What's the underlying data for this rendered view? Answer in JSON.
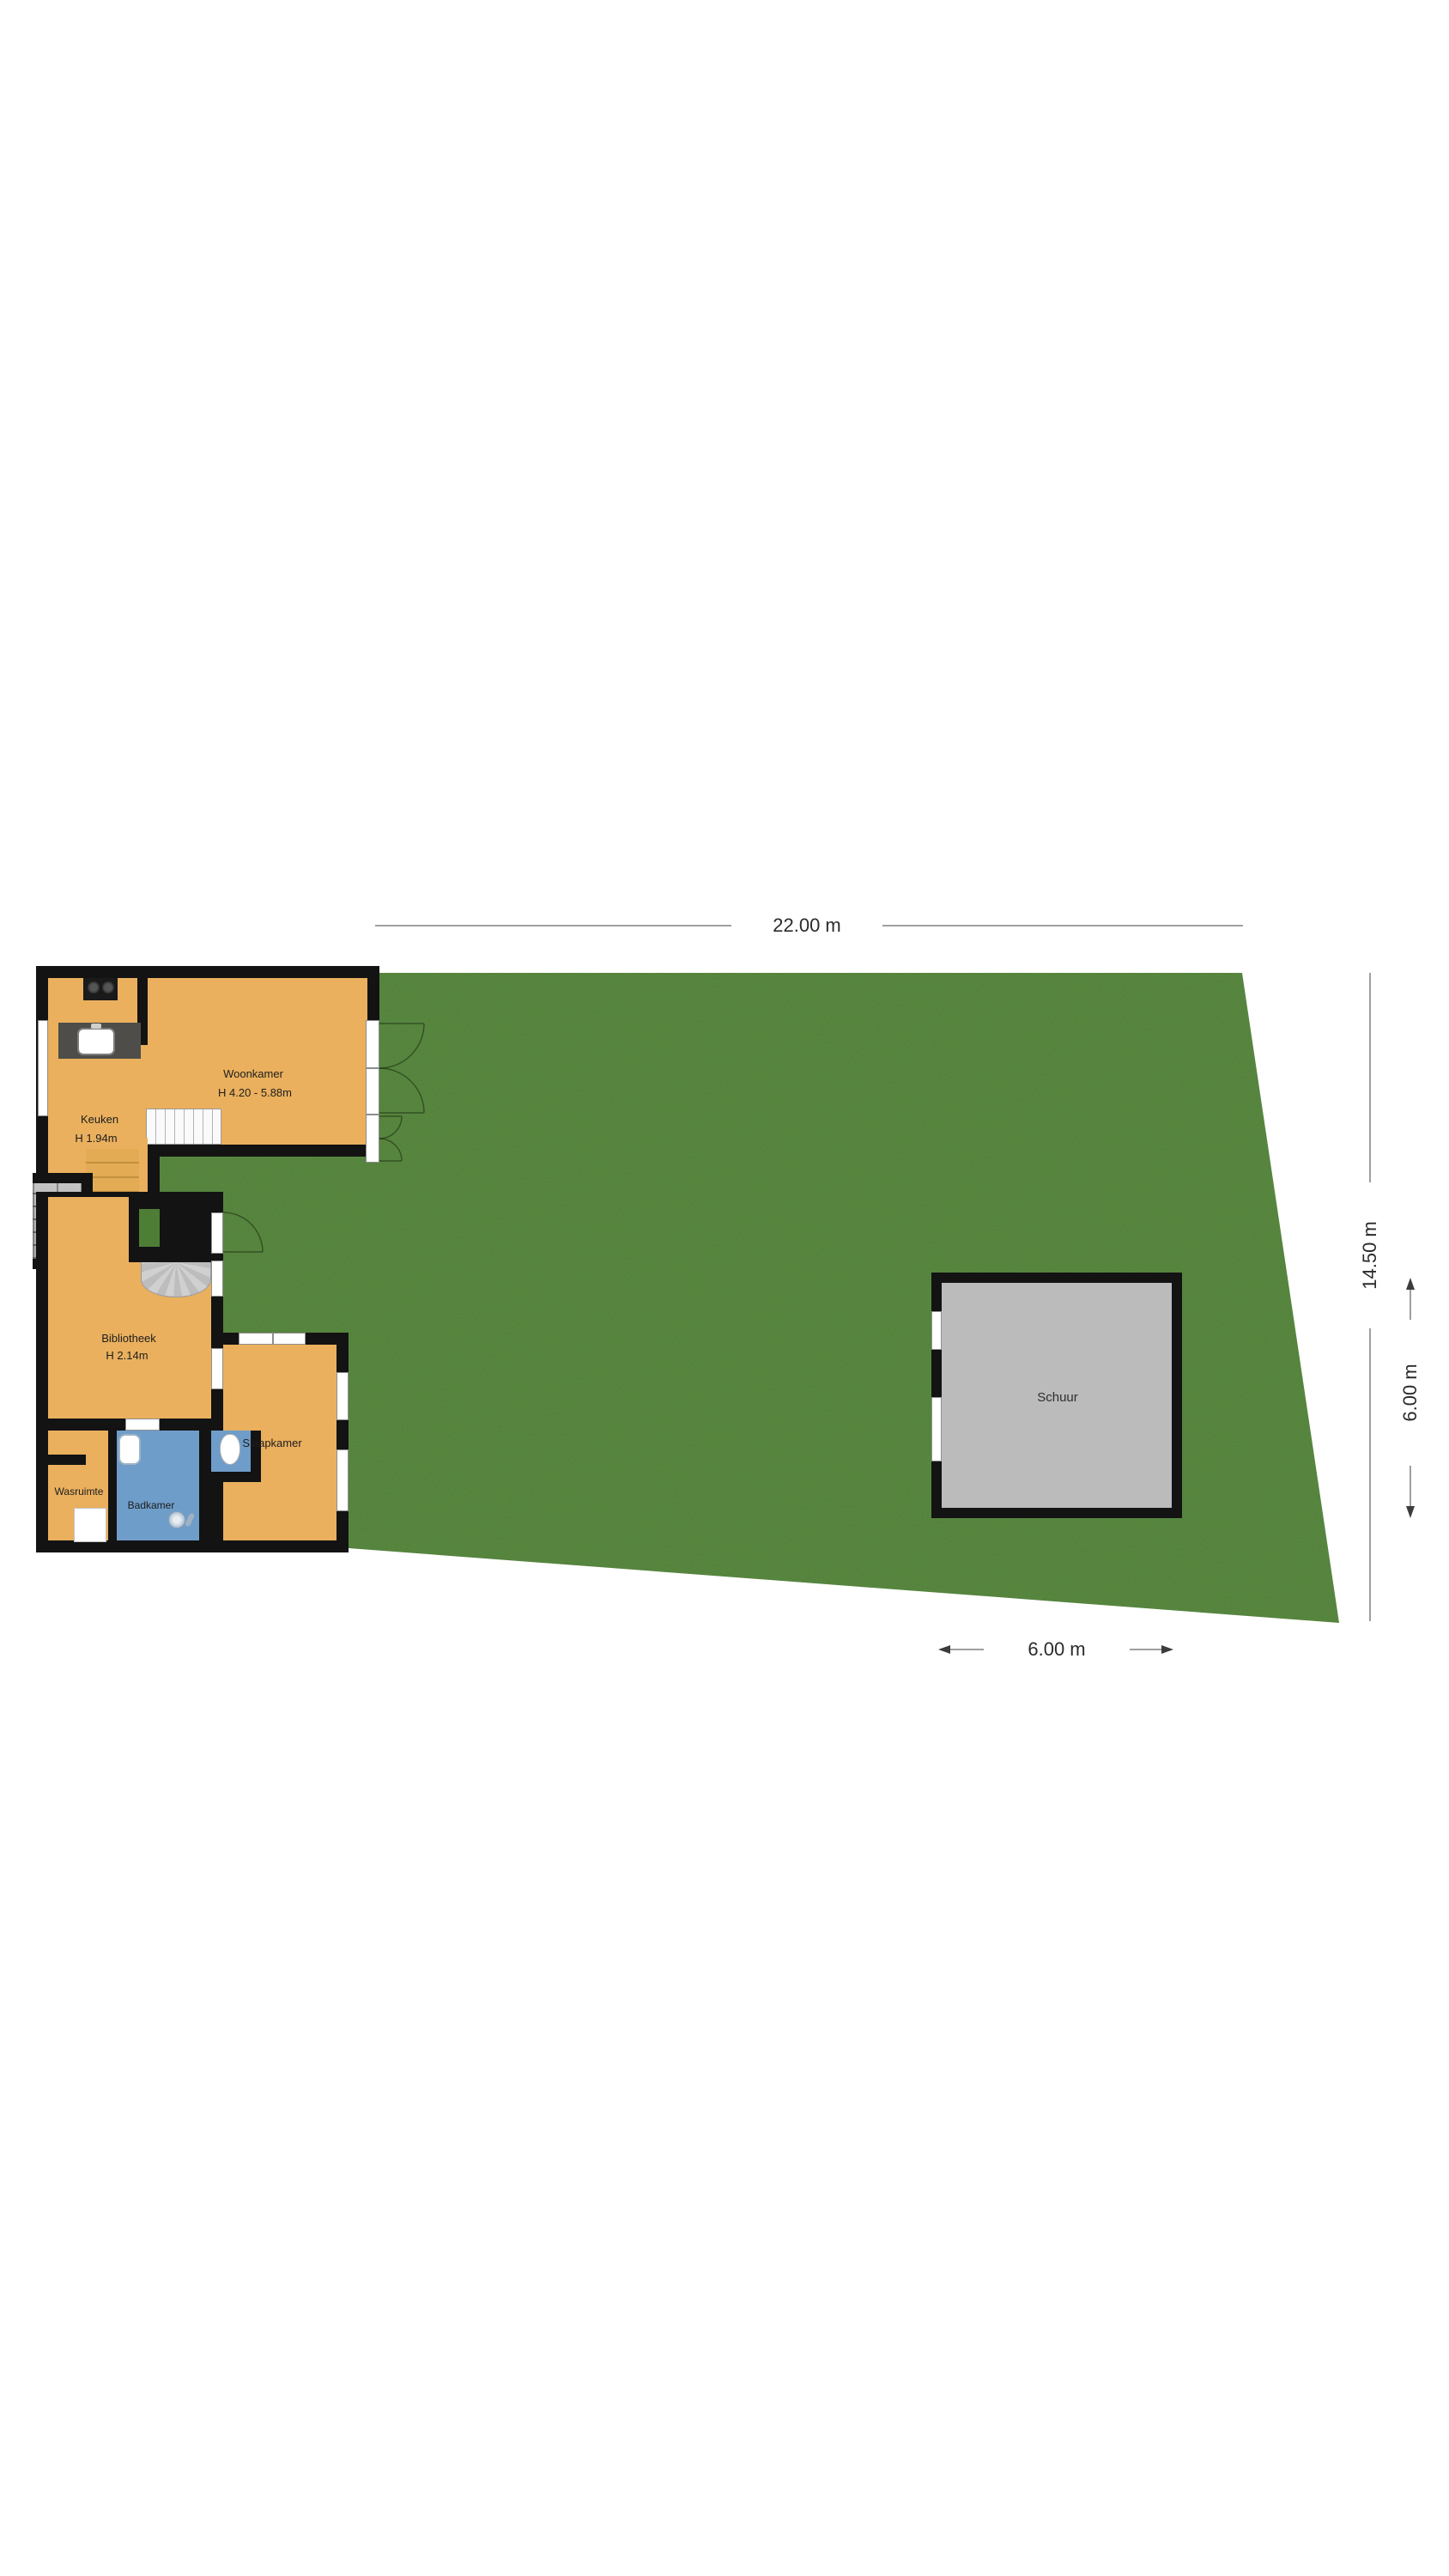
{
  "floorplan": {
    "title": "Begane grond plattegrond",
    "rooms": {
      "woonkamer": {
        "label": "Woonkamer",
        "height": "H 4.20 - 5.88m"
      },
      "keuken": {
        "label": "Keuken",
        "height": "H 1.94m"
      },
      "bibliotheek": {
        "label": "Bibliotheek",
        "height": "H 2.14m"
      },
      "slaapkamer": {
        "label": "Slaapkamer"
      },
      "badkamer": {
        "label": "Badkamer"
      },
      "wasruimte": {
        "label": "Wasruimte"
      },
      "schuur": {
        "label": "Schuur"
      }
    },
    "dimensions": {
      "plot_width": "22.00 m",
      "plot_depth": "14.50 m",
      "shed_width": "6.00 m",
      "shed_depth": "6.00 m"
    },
    "colors": {
      "room_fill": "#EAB05E",
      "garden": "#4E7E36",
      "wall": "#131313",
      "shed_fill": "#BBBBBB",
      "bathroom_fill": "#6F9DCA",
      "dimension_line": "#9f9f9f"
    }
  }
}
